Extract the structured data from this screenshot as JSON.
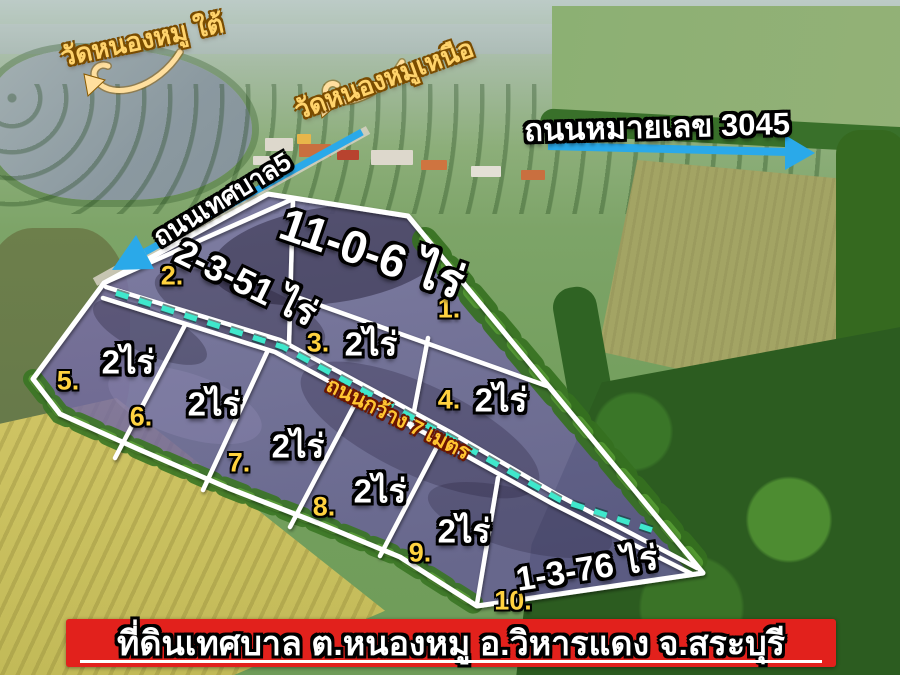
{
  "scene": {
    "temple_label_left": "วัดหนองหมู ใต้",
    "temple_label_right": "วัดหนองหมูเหนือ",
    "highway_label": "ถนนหมายเลข 3045",
    "municipal_road_label": "ถนนเทศบาล5",
    "internal_road_label": "ถนนกว้าง 7 เมตร"
  },
  "plots": [
    {
      "number": "1.",
      "area": "11-0-6 ไร่"
    },
    {
      "number": "2.",
      "area": "2-3-51 ไร่"
    },
    {
      "number": "3.",
      "area": "2ไร่"
    },
    {
      "number": "4.",
      "area": "2ไร่"
    },
    {
      "number": "5.",
      "area": "2ไร่"
    },
    {
      "number": "6.",
      "area": "2ไร่"
    },
    {
      "number": "7.",
      "area": "2ไร่"
    },
    {
      "number": "8.",
      "area": "2ไร่"
    },
    {
      "number": "9.",
      "area": "2ไร่"
    },
    {
      "number": "10.",
      "area": "1-3-76 ไร่"
    }
  ],
  "banner": {
    "text": "ที่ดินเทศบาล ต.หนองหมู อ.วิหารแดง จ.สระบุรี"
  },
  "colors": {
    "plot_overlay_purple": "#6f64a4",
    "boundary_white": "#ffffff",
    "road_dash_teal": "#3fe8cc",
    "arrow_blue": "#2aa9e9",
    "label_yellow": "#ffd23f",
    "banner_red": "#e2211c"
  }
}
